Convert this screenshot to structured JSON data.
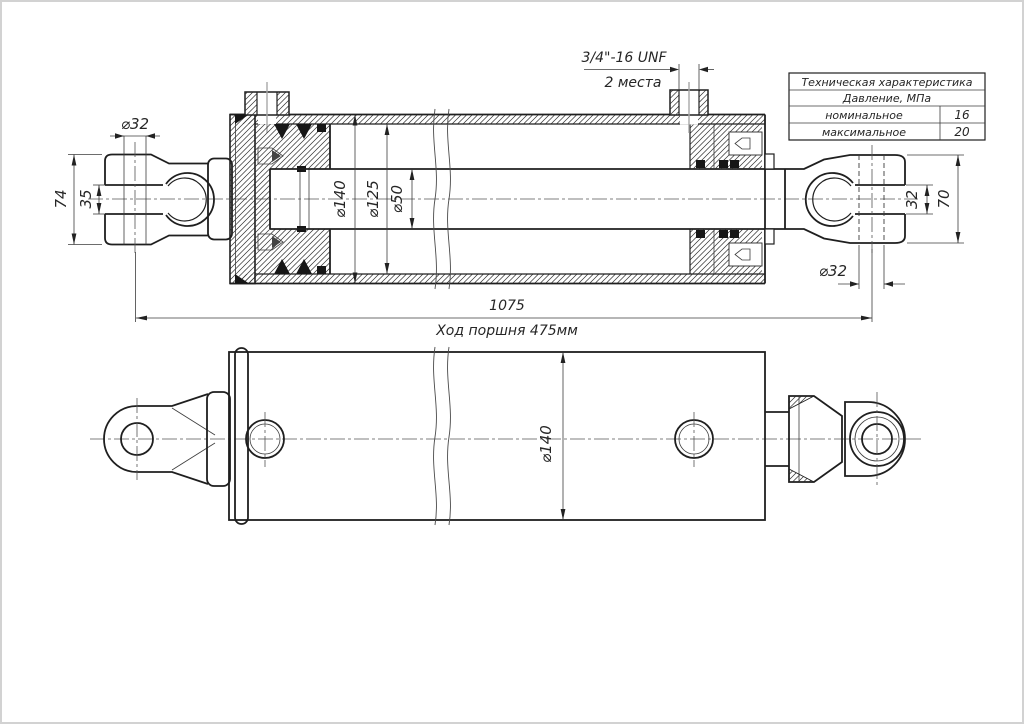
{
  "table": {
    "title": "Техническая характеристика",
    "subtitle": "Давление, МПа",
    "rows": [
      {
        "label": "номинальное",
        "value": "16"
      },
      {
        "label": "максимальное",
        "value": "20"
      }
    ]
  },
  "callouts": {
    "thread_spec": "3/4\"-16 UNF",
    "thread_places": "2 места"
  },
  "dims": {
    "eye_hole_left": "⌀32",
    "clevis_height_left": "74",
    "slot_width_left": "35",
    "barrel_od": "⌀140",
    "bore_d": "⌀125",
    "rod_d": "⌀50",
    "slot_width_right": "32",
    "clevis_height_right": "70",
    "eye_hole_right": "⌀32",
    "overall_length": "1075",
    "stroke_note": "Ход поршня 475мм",
    "barrel_od_plan": "⌀140"
  },
  "colors": {
    "line": "#1f1f1f",
    "thin_line": "#3c3c3c",
    "centerline": "#555555",
    "background": "#ffffff",
    "page_border": "#d2d2d2"
  }
}
